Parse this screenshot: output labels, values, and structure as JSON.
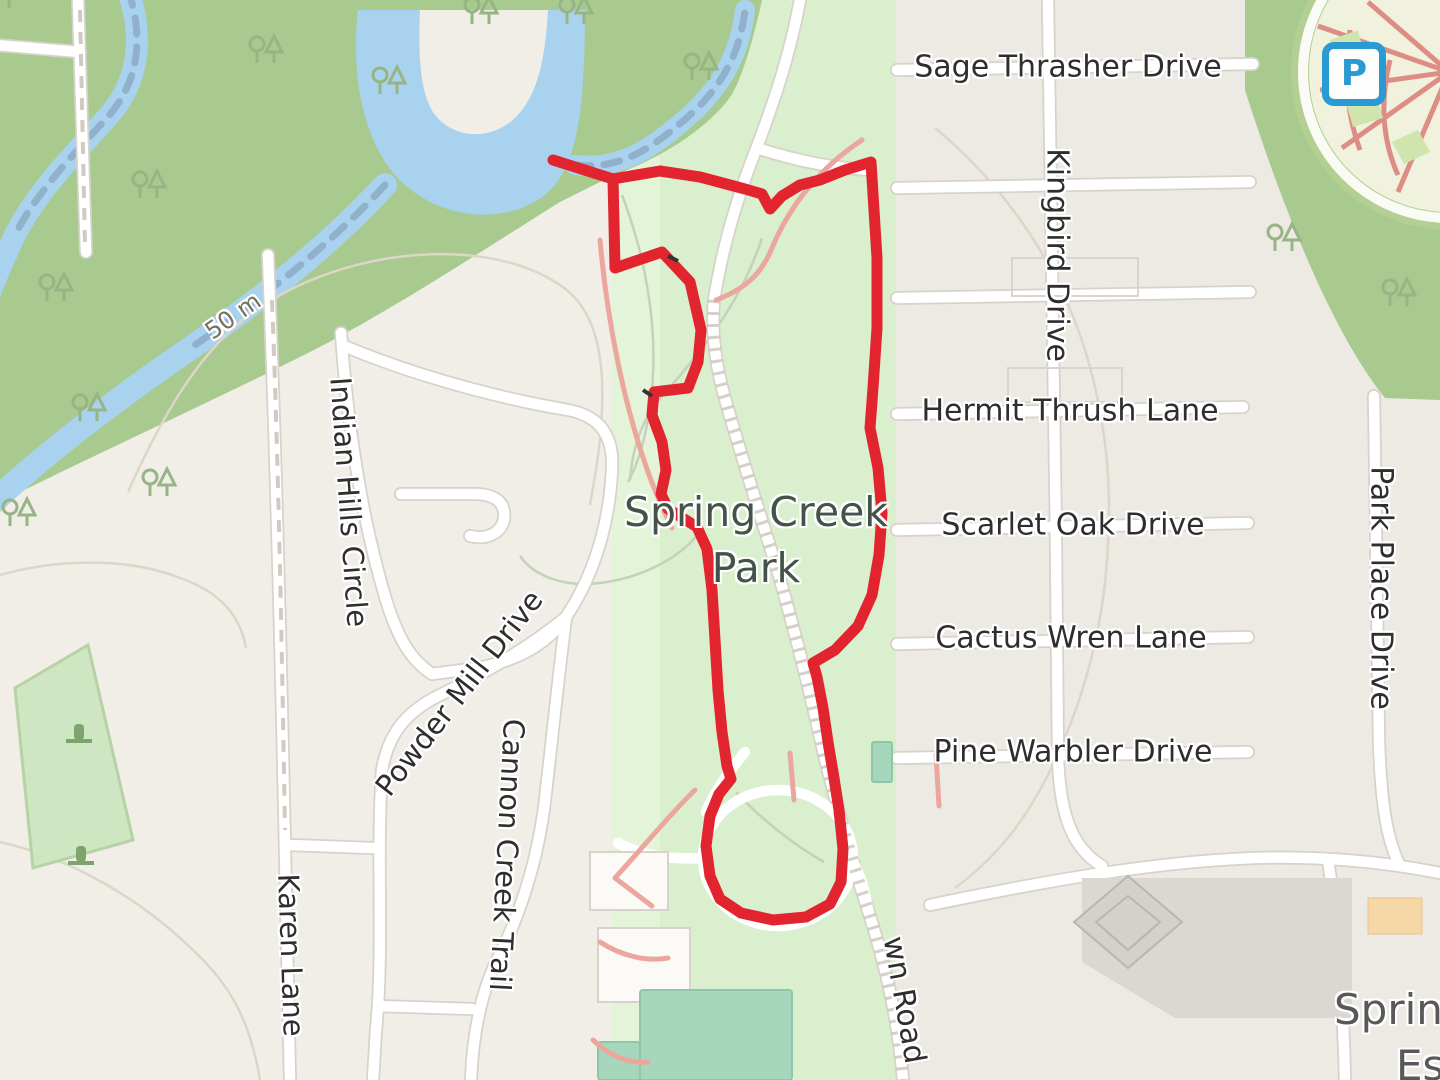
{
  "map": {
    "streets": {
      "sage_thrasher": "Sage Thrasher Drive",
      "kingbird": "Kingbird Drive",
      "hermit_thrush": "Hermit Thrush Lane",
      "scarlet_oak": "Scarlet Oak Drive",
      "cactus_wren": "Cactus Wren Lane",
      "pine_warbler": "Pine Warbler Drive",
      "park_place": "Park Place Drive",
      "indian_hills": "Indian Hills Circle",
      "powder_mill": "Powder Mill Drive",
      "cannon_creek": "Cannon Creek Trail",
      "karen_lane": "Karen Lane",
      "wn_road": "wn Road"
    },
    "park_label": {
      "line1": "Spring Creek",
      "line2": "Park"
    },
    "estates_label": {
      "line1": "Spring",
      "line2": "Estates"
    },
    "contour_label": "50 m",
    "parking_icon": "P",
    "colors": {
      "route_red": "#e1242d",
      "park_green": "#d9efce",
      "forest_green": "#a8ca8e",
      "water_blue": "#a9d2ee",
      "trail_pink": "#eba79d",
      "field_teal": "#a6d7bd",
      "parking_blue": "#2a9ad2"
    },
    "route_points": [
      [
        553,
        160
      ],
      [
        613,
        179
      ],
      [
        615,
        268
      ],
      [
        662,
        252
      ],
      [
        690,
        282
      ],
      [
        701,
        330
      ],
      [
        698,
        362
      ],
      [
        688,
        388
      ],
      [
        654,
        392
      ],
      [
        652,
        415
      ],
      [
        662,
        442
      ],
      [
        666,
        470
      ],
      [
        661,
        494
      ],
      [
        668,
        509
      ],
      [
        697,
        527
      ],
      [
        707,
        549
      ],
      [
        712,
        590
      ],
      [
        715,
        640
      ],
      [
        718,
        690
      ],
      [
        722,
        732
      ],
      [
        727,
        766
      ],
      [
        731,
        779
      ],
      [
        719,
        794
      ],
      [
        710,
        816
      ],
      [
        706,
        846
      ],
      [
        710,
        876
      ],
      [
        720,
        899
      ],
      [
        741,
        913
      ],
      [
        773,
        920
      ],
      [
        806,
        917
      ],
      [
        830,
        904
      ],
      [
        841,
        882
      ],
      [
        843,
        849
      ],
      [
        839,
        810
      ],
      [
        834,
        778
      ],
      [
        828,
        742
      ],
      [
        823,
        708
      ],
      [
        817,
        677
      ],
      [
        813,
        663
      ],
      [
        835,
        650
      ],
      [
        858,
        626
      ],
      [
        872,
        595
      ],
      [
        879,
        555
      ],
      [
        882,
        513
      ],
      [
        878,
        468
      ],
      [
        870,
        428
      ],
      [
        873,
        388
      ],
      [
        877,
        328
      ],
      [
        877,
        258
      ],
      [
        873,
        194
      ],
      [
        871,
        162
      ],
      [
        845,
        170
      ],
      [
        820,
        180
      ],
      [
        800,
        185
      ],
      [
        782,
        196
      ],
      [
        770,
        209
      ],
      [
        762,
        194
      ],
      [
        745,
        189
      ],
      [
        700,
        177
      ],
      [
        660,
        171
      ],
      [
        613,
        179
      ]
    ]
  }
}
